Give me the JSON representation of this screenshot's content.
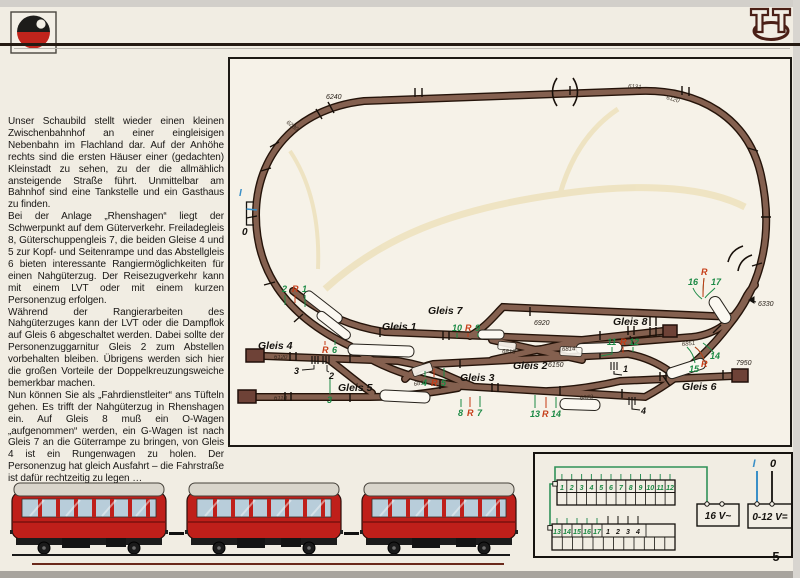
{
  "page": {
    "number": "5"
  },
  "article": {
    "paragraphs": [
      "Unser Schaubild stellt wieder einen kleinen Zwischenbahnhof an einer eingleisigen Nebenbahn im Flachland dar. Auf der Anhöhe rechts sind die ersten Häuser einer (gedachten) Kleinstadt zu sehen, zu der die allmählich ansteigende Straße führt. Unmittelbar am Bahnhof sind eine Tankstelle und ein Gasthaus zu finden.",
      "Bei der Anlage „Rhenshagen“ liegt der Schwerpunkt auf dem Güterverkehr. Freiladegleis 8, Güterschuppengleis 7, die beiden Gleise 4 und 5 zur Kopf- und Seitenrampe und das Abstellgleis 6 bieten interessante Rangiermöglichkeiten für einen Nahgüterzug. Der Reisezugverkehr kann mit einem LVT oder mit einem kurzen Personenzug erfolgen.",
      "Während der Rangierarbeiten des Nahgüterzuges kann der LVT oder die Dampflok auf Gleis 6 abgeschaltet werden. Dabei sollte der Personenzuggarnitur Gleis 2 zum Abstellen vorbehalten bleiben. Übrigens werden sich hier die großen Vorteile der Doppelkreuzungsweiche bemerkbar machen.",
      "Nun können Sie als „Fahrdienstleiter“ ans Tüfteln gehen. Es trifft der Nahgüterzug in Rhenshagen ein. Auf Gleis 8 muß ein O-Wagen „aufgenommen“ werden, ein G-Wagen ist nach Gleis 7 an die Güterrampe zu bringen, von Gleis 4 ist ein Rungenwagen zu holen. Der Personenzug hat gleich Ausfahrt – die Fahrstraße ist dafür rechtzeitig zu legen …"
    ]
  },
  "diagram": {
    "gleis": {
      "g1": "Gleis 1",
      "g2": "Gleis 2",
      "g3": "Gleis 3",
      "g4": "Gleis 4",
      "g5": "Gleis 5",
      "g6": "Gleis 6",
      "g7": "Gleis 7",
      "g8": "Gleis 8"
    },
    "parts": {
      "p6240": "6240",
      "p6230": "6230",
      "p6131": "6131",
      "p6120": "6120",
      "p6920": "6920",
      "p6813": "6813",
      "p6814a": "6814",
      "p6814b": "6814",
      "p6150": "6150",
      "p6851": "6851",
      "p6873": "6873",
      "p6330": "6330",
      "p7950": "7950",
      "pg4": "6120",
      "pg5": "6110"
    },
    "switches": {
      "s1a": "2",
      "s1r": "R",
      "s1b": "1",
      "s2r": "R",
      "s2b": "6",
      "s2c": "3",
      "s3a": "10",
      "s3r": "R",
      "s3b": "9",
      "s4a": "4",
      "s4r": "R",
      "s4b": "5",
      "s5a": "8",
      "s5r": "R",
      "s5b": "7",
      "s6a": "11",
      "s6r": "R",
      "s6b": "12",
      "s7a": "13",
      "s7r": "R",
      "s7b": "14",
      "s8a": "15",
      "s8r": "R",
      "s8b": "14",
      "s9a": "16",
      "s9r": "R",
      "s9b": "17"
    },
    "uncouplers": {
      "u1": "1",
      "u2": "2",
      "u3": "3",
      "u4": "4"
    },
    "feed": {
      "i": "I",
      "zero": "0"
    }
  },
  "panel": {
    "row1": [
      "1",
      "2",
      "3",
      "4",
      "5",
      "6",
      "7",
      "8",
      "9",
      "10",
      "11",
      "12"
    ],
    "row2_green": [
      "13",
      "14",
      "15",
      "16",
      "17"
    ],
    "row2_black": [
      "1",
      "2",
      "3",
      "4"
    ],
    "ac": "16 V~",
    "dc": "0-12 V=",
    "i": "I",
    "zero": "0"
  },
  "colors": {
    "track": "#84604f",
    "green": "#1c8a45",
    "red": "#c53a14",
    "railbus_red": "#bf1f1a",
    "feed_blue": "#3a8fc7"
  }
}
